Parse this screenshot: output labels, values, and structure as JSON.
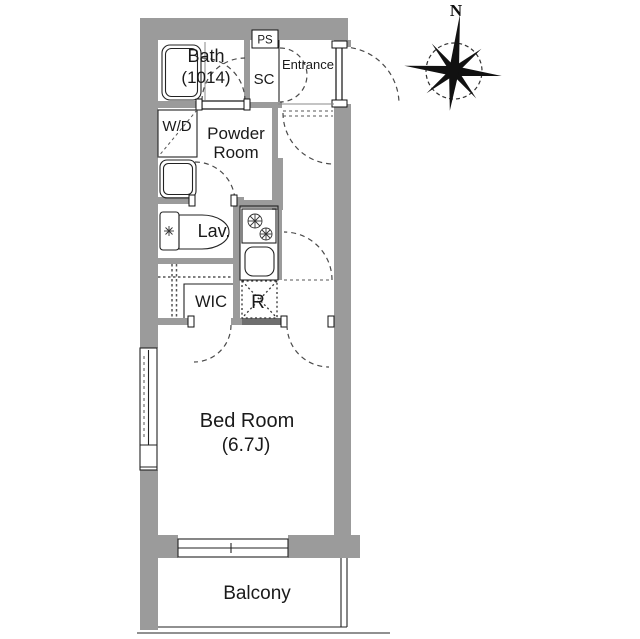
{
  "compass": {
    "north_label": "N"
  },
  "rooms": {
    "bath": {
      "name": "Bath",
      "size": "(1014)"
    },
    "ps": {
      "label": "PS"
    },
    "sc": {
      "label": "SC"
    },
    "entrance": {
      "label": "Entrance"
    },
    "washer_dryer": {
      "label": "W/D"
    },
    "powder_room": {
      "name_line1": "Powder",
      "name_line2": "Room"
    },
    "lavatory": {
      "label": "Lav."
    },
    "wic": {
      "label": "WIC"
    },
    "refrigerator": {
      "label": "R"
    },
    "bedroom": {
      "name": "Bed Room",
      "size": "(6.7J)"
    },
    "balcony": {
      "label": "Balcony"
    }
  },
  "colors": {
    "wall": "#9b9b9b",
    "hatch": "#6f6f6f",
    "line": "#1a1a1a",
    "background": "#ffffff"
  }
}
